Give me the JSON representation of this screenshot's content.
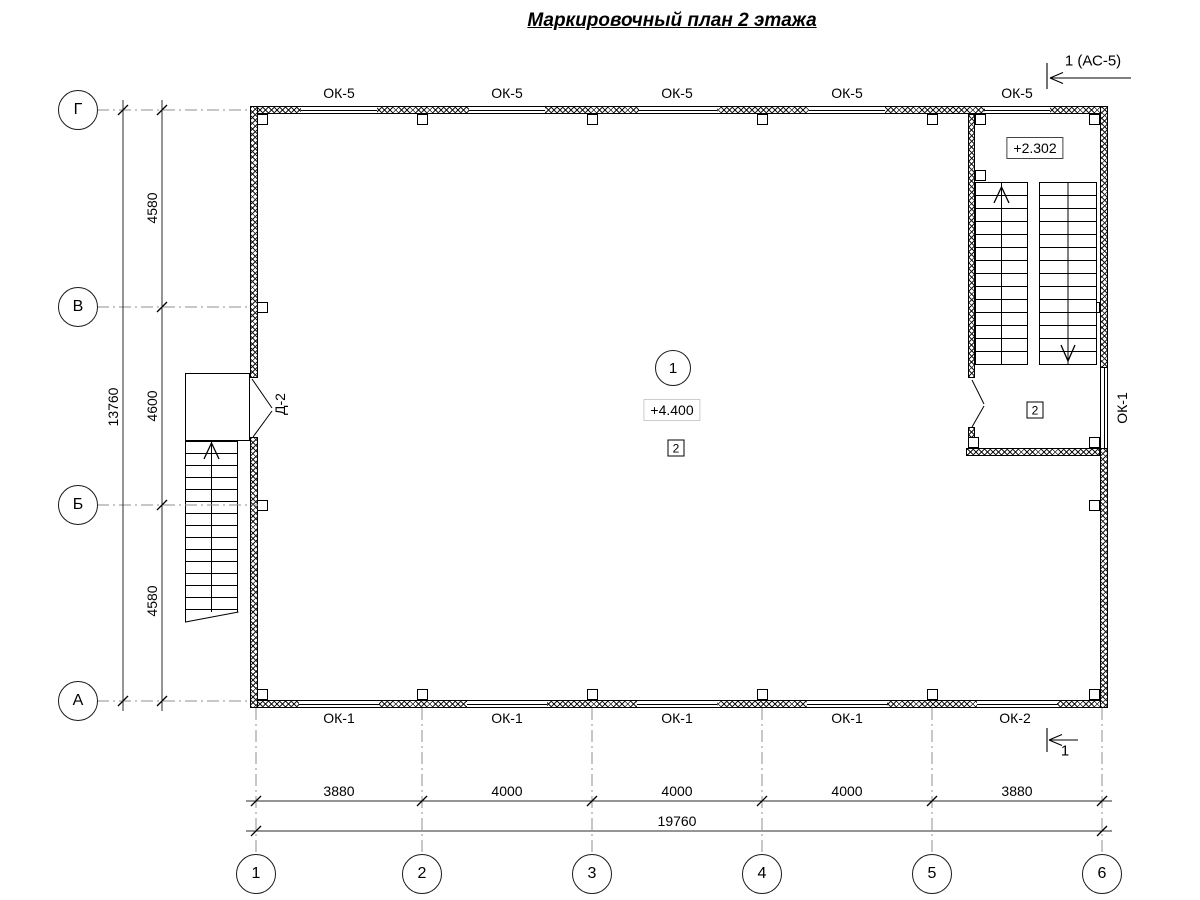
{
  "title": "Маркировочный план 2 этажа",
  "section_marks": {
    "top": "1 (АС-5)",
    "bottom": "1"
  },
  "axes": {
    "rows": [
      "Г",
      "В",
      "Б",
      "А"
    ],
    "cols": [
      "1",
      "2",
      "3",
      "4",
      "5",
      "6"
    ]
  },
  "dimensions": {
    "left_bays": [
      "4580",
      "4600",
      "4580"
    ],
    "left_overall": "13760",
    "bottom_bays": [
      "3880",
      "4000",
      "4000",
      "4000",
      "3880"
    ],
    "bottom_overall": "19760"
  },
  "windows": {
    "top": [
      "ОК-5",
      "ОК-5",
      "ОК-5",
      "ОК-5",
      "ОК-5"
    ],
    "bottom": [
      "ОК-1",
      "ОК-1",
      "ОК-1",
      "ОК-1",
      "ОК-2"
    ],
    "right": "ОК-1"
  },
  "door": {
    "label": "Д-2"
  },
  "main_room": {
    "number": "1",
    "elevation": "+4.400",
    "finish_badge": "2"
  },
  "stairwell": {
    "elevation": "+2.302",
    "finish_badge": "2"
  }
}
